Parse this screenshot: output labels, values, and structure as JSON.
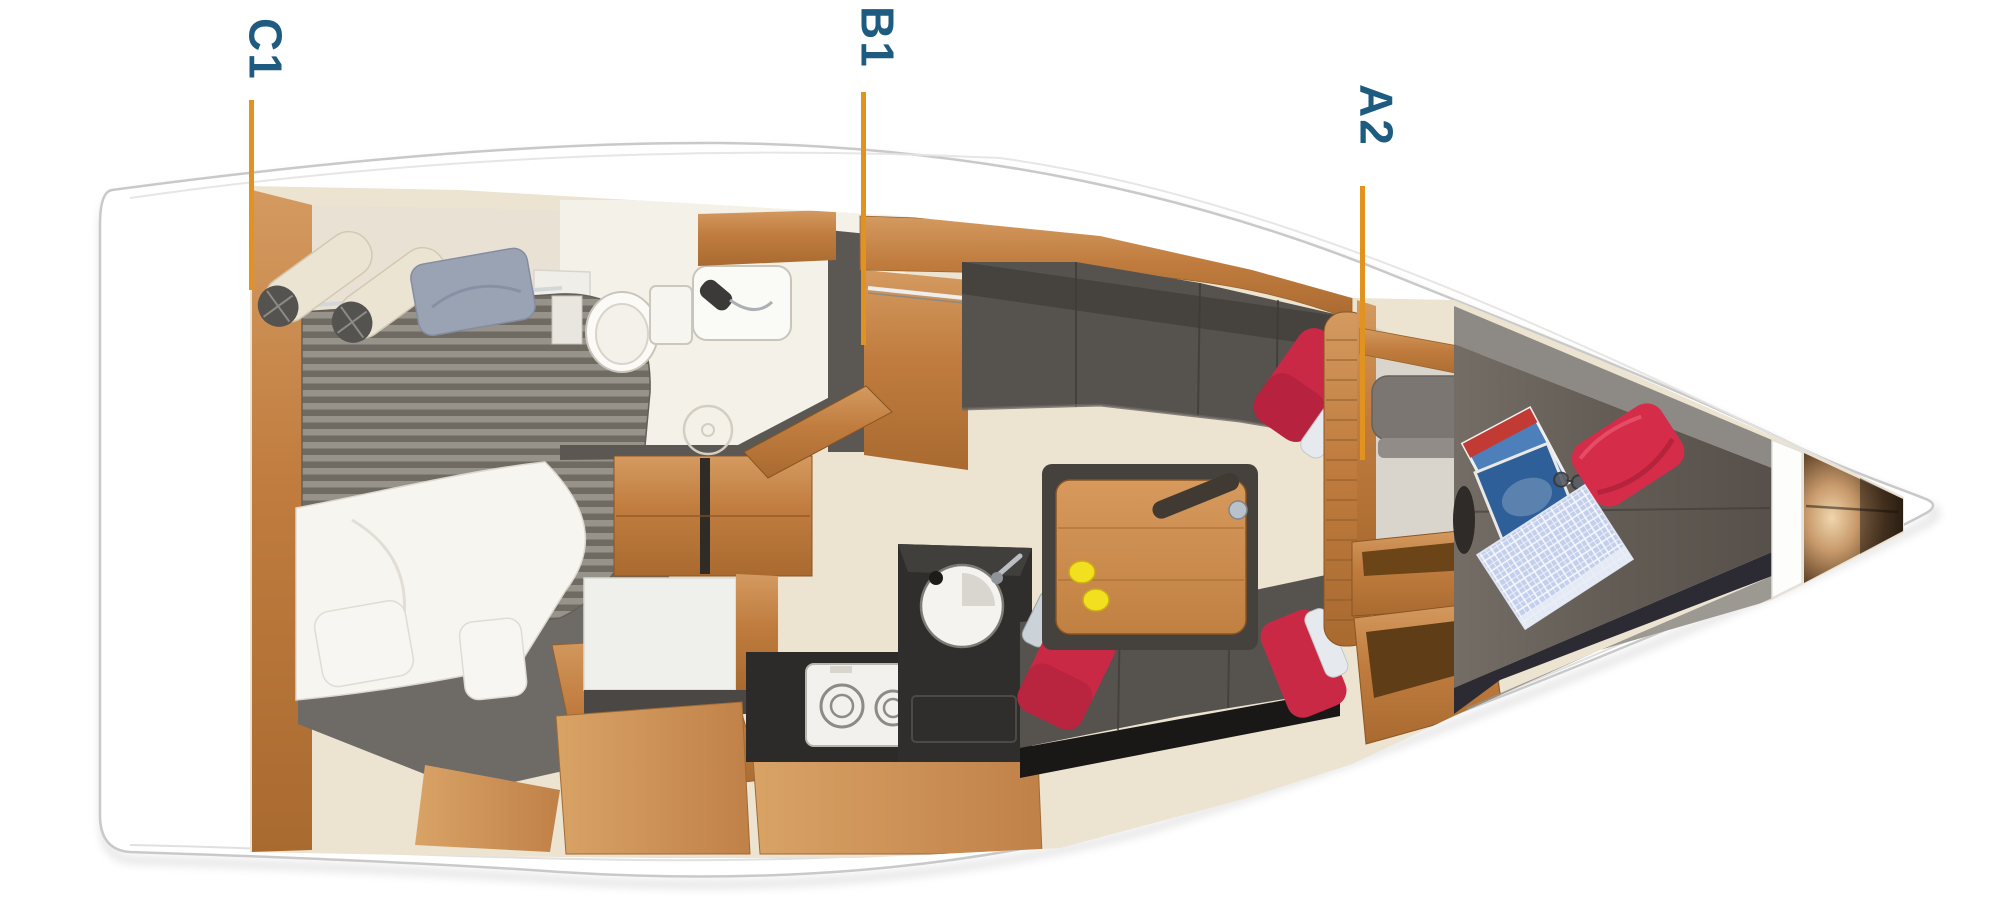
{
  "page": {
    "background": "#FFFFFF",
    "description": "Top-view interior layout plan of a sailing yacht, bow pointing right, with three labelled section lines"
  },
  "markers": [
    {
      "id": "C1",
      "label": "C1"
    },
    {
      "id": "B1",
      "label": "B1"
    },
    {
      "id": "A2",
      "label": "A2"
    }
  ],
  "marker_style": {
    "line_color": "#E2921E",
    "label_color": "#1D5C80"
  },
  "colors": {
    "hull_white": "#FFFFFF",
    "hull_outline": "#C9C9C9",
    "wood_teak": "#C07C3E",
    "floor_beige": "#ECE3D1",
    "head_floor": "#F4F1E8",
    "upholstery_gray": "#56524E",
    "berth_gray": "#6A635C",
    "mattress_stripe_light": "#97938B",
    "mattress_stripe_dark": "#6F6B63",
    "cushion_red": "#CB2945",
    "lemon_yellow": "#F2DF1F",
    "towel_blue": "#C3CFEC",
    "pillow_blue_gray": "#9AA3B4",
    "counter_black": "#2D2B29"
  },
  "regions": [
    "aft-cabin",
    "head-bathroom",
    "companionway",
    "galley",
    "saloon",
    "mast-post",
    "forward-cabin",
    "anchor-locker"
  ]
}
